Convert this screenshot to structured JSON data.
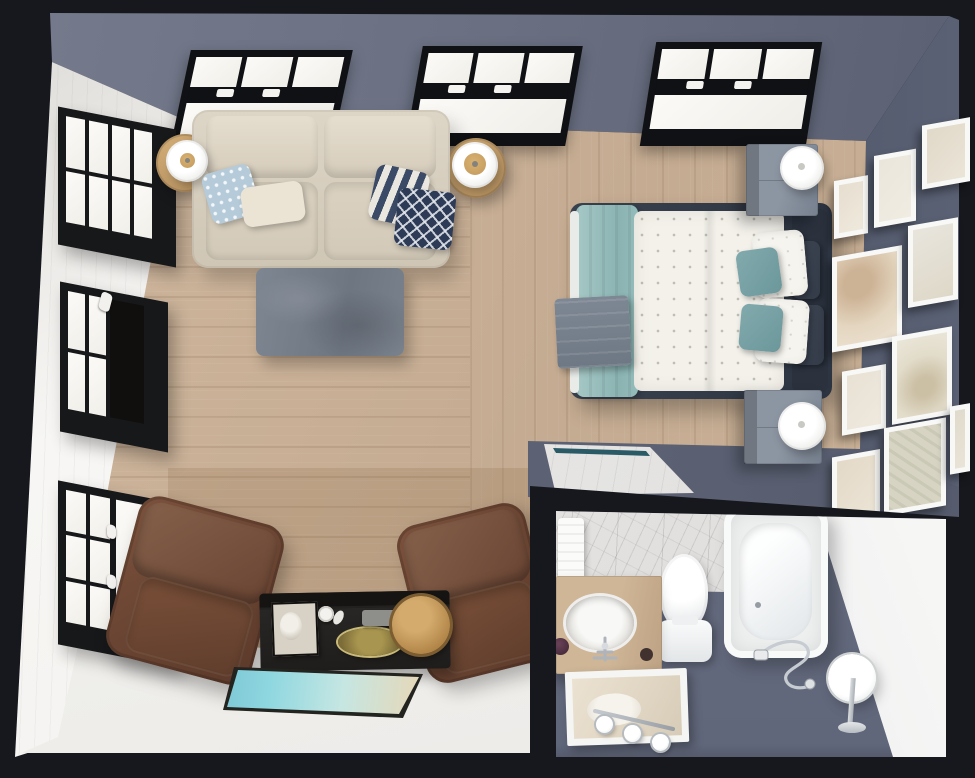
{
  "scene": {
    "title": "Studio apartment - 3D top-down floor plan render",
    "view": "bird's-eye dollhouse cutaway",
    "rooms": [
      "living area",
      "sleeping area",
      "lounge corner",
      "bathroom"
    ],
    "visible_text": ""
  },
  "palette": {
    "outer_wall_black": "#16181d",
    "wall_slate_top": "#6a7082",
    "wall_slate_right": "#454c5d",
    "wall_white": "#f6f5f3",
    "floor_wood": "#c8af96",
    "floor_white": "#f0efec",
    "floor_bath_gray": "#6b7183",
    "accent_teal": "#93bcba",
    "accent_navy": "#333b4a",
    "leather_brown": "#6f4a37",
    "brass_gold": "#c09457"
  },
  "living_area": {
    "items": [
      "beige two-seat sofa",
      "round wood side table with white lamp (left)",
      "round wood side table with white lamp (right)",
      "gray fabric ottoman coffee table",
      "light-blue floral pillow",
      "cream script pillow",
      "navy striped pillow",
      "navy diamond-pattern pillow"
    ]
  },
  "sleeping_area": {
    "items": [
      "double bed with dark navy upholstered frame",
      "white patterned duvet",
      "teal end-of-bed throw",
      "gray folded blanket",
      "two teal accent pillows",
      "two white pillows",
      "two navy headboard cushions",
      "gray nightstand with white lamp (top)",
      "gray nightstand with white lamp (bottom)",
      "gallery wall of ten white picture frames",
      "recessed marble niche with teal trim"
    ]
  },
  "lounge_corner": {
    "items": [
      "brown leather armchair (left)",
      "brown leather armchair (right)",
      "black trunk coffee table",
      "brass round tray",
      "gold plate",
      "white cup",
      "framed photo",
      "gray tray",
      "landscape canvas print lying on floor"
    ]
  },
  "bathroom": {
    "items": [
      "white bathtub",
      "toilet",
      "wood vanity with oval sink and chrome faucet",
      "wall mirror with three sconce lights",
      "marble tiled wall",
      "white hand towel",
      "chrome shower hand set",
      "round standing mirror on chrome stand",
      "plum soap dish"
    ]
  },
  "windows": {
    "top_wall_skylights": 3,
    "left_wall_windows": 3,
    "frame_color": "black",
    "glazing": "white daylight panes"
  },
  "gallery": {
    "frame_count": 10,
    "frame_color": "white",
    "art_style": "soft beige abstract prints"
  }
}
